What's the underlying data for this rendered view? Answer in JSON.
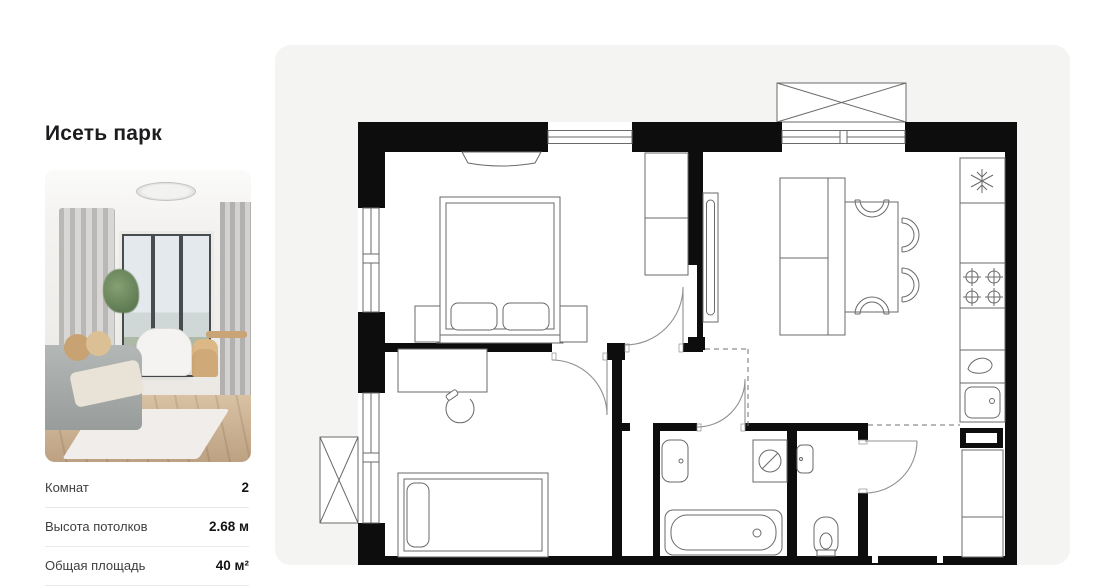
{
  "sidebar": {
    "title": "Исеть парк",
    "photo_alt": "apartment-interior-photo",
    "details": [
      {
        "label": "Комнат",
        "value": "2"
      },
      {
        "label": "Высота потолков",
        "value": "2.68 м"
      },
      {
        "label": "Общая площадь",
        "value": "40 м²"
      }
    ]
  },
  "floor_plan": {
    "type": "2-room apartment plan, no text labels rendered",
    "rooms": [
      "bedroom",
      "kitchen-living-room",
      "second-room",
      "hallway",
      "bathroom",
      "wc",
      "entry-lobby"
    ],
    "fixtures": [
      "double-bed",
      "nightstands",
      "wall-shelf",
      "wardrobe-cabinet",
      "tv-panel",
      "sofa",
      "dining-table",
      "four-chairs",
      "fridge-snowflake-icon",
      "stove-four-burners",
      "faucet-drop-icon",
      "kitchen-sink",
      "tall-cabinet",
      "desk",
      "desk-chair",
      "single-bed",
      "wash-basin",
      "washing-machine-icon",
      "bathtub",
      "corner-sink",
      "toilet",
      "two-balconies-x-box",
      "windows",
      "door-swing-arcs",
      "dashed-zone-lines"
    ]
  },
  "colors": {
    "page_bg": "#ffffff",
    "panel_bg": "#f4f4f2",
    "wall": "#0d0d0d",
    "furniture_line": "#6a6a6a",
    "door_line": "#909090",
    "title_text": "#1d1d1f",
    "label_text": "#3f3f41",
    "value_text": "#141415"
  }
}
